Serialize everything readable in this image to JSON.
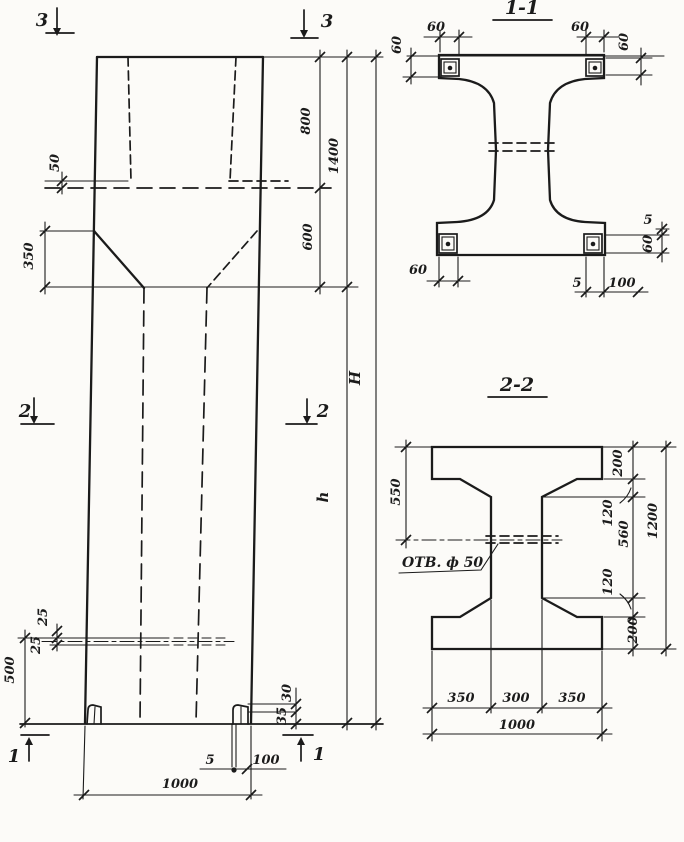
{
  "colors": {
    "ink": "#1b1b1b",
    "paper": "#fcfbf8"
  },
  "elevation": {
    "markers": {
      "top_left": "3",
      "top_right": "3",
      "mid_left": "2",
      "mid_right": "2",
      "bottom_left": "1",
      "bottom_right": "1"
    },
    "dims": {
      "plate_height": "50",
      "taper_height": "350",
      "cap_upper": "800",
      "cap_total": "1400",
      "cap_lower": "600",
      "overall_height": "H",
      "shaft_height": "h",
      "mid_plate_upper": "25",
      "mid_plate_lower": "25",
      "base_zone": "500",
      "foot_plate_upper": "30",
      "foot_plate_lower": "35",
      "anchor_offset": "5",
      "anchor_plate": "100",
      "column_width": "1000"
    }
  },
  "section_1_1": {
    "title": "1-1",
    "dims": {
      "top_left_width": "60",
      "top_left_height": "60",
      "top_right_width": "60",
      "top_right_height": "60",
      "bottom_left_width": "60",
      "bottom_offset": "5",
      "bottom_plate": "100",
      "right_offset": "5",
      "right_plate_height": "60"
    }
  },
  "section_2_2": {
    "title": "2-2",
    "hole_label": "ОТВ. ф 50",
    "dims": {
      "flange_to_hole": "550",
      "top_flange": "200",
      "top_haunch": "120",
      "web_height": "560",
      "bottom_haunch": "120",
      "bottom_flange": "200",
      "section_height": "1200",
      "left_flange_width": "350",
      "web_width": "300",
      "right_flange_width": "350",
      "section_width": "1000"
    }
  }
}
